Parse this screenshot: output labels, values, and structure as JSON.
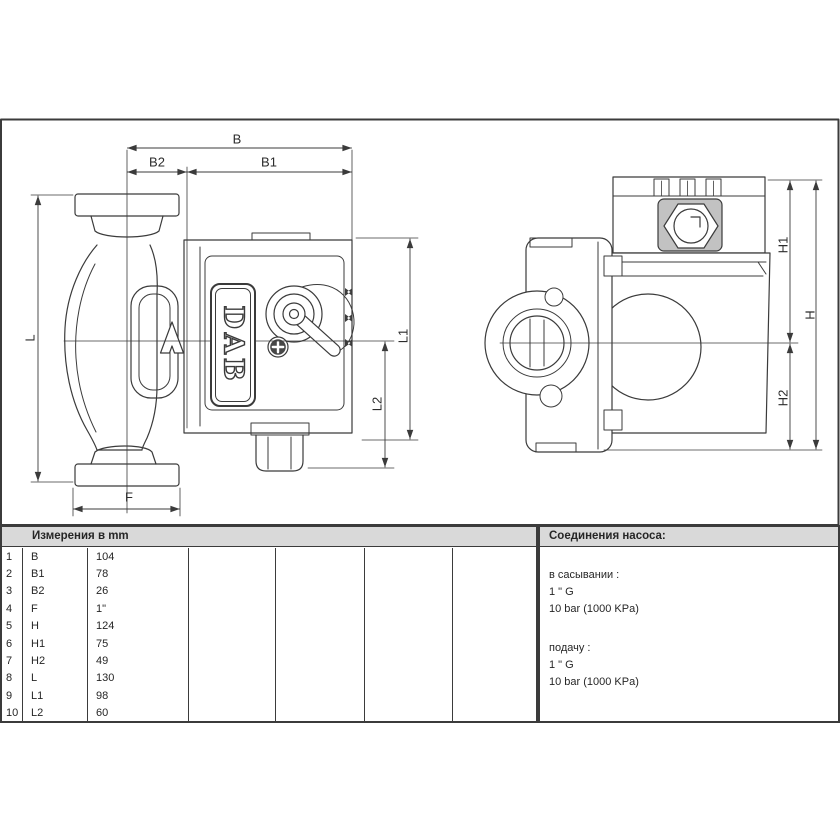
{
  "drawing": {
    "labels": {
      "b": "B",
      "b1": "B1",
      "b2": "B2",
      "l": "L",
      "f": "F",
      "l1": "L1",
      "l2": "L2",
      "h": "H",
      "h1": "H1",
      "h2": "H2"
    },
    "logo": "DAB"
  },
  "table": {
    "header": "Измерения в  mm",
    "rows": [
      {
        "num": "1",
        "name": "B",
        "value": "104"
      },
      {
        "num": "2",
        "name": "B1",
        "value": "78"
      },
      {
        "num": "3",
        "name": "B2",
        "value": "26"
      },
      {
        "num": "4",
        "name": "F",
        "value": "1\""
      },
      {
        "num": "5",
        "name": "H",
        "value": "124"
      },
      {
        "num": "6",
        "name": "H1",
        "value": "75"
      },
      {
        "num": "7",
        "name": "H2",
        "value": "49"
      },
      {
        "num": "8",
        "name": "L",
        "value": "130"
      },
      {
        "num": "9",
        "name": "L1",
        "value": "98"
      },
      {
        "num": "10",
        "name": "L2",
        "value": "60"
      }
    ]
  },
  "connections": {
    "header": "Соединения насоса:",
    "suction": {
      "label": "в сасывании :",
      "size": "1 \" G",
      "pressure": "10 bar (1000 KPa)"
    },
    "delivery": {
      "label": "подачу :",
      "size": "1 \" G",
      "pressure": "10 bar (1000 KPa)"
    }
  },
  "colors": {
    "line": "#3b3b3b",
    "header_bg": "#d9d9d9",
    "text": "#262626"
  }
}
